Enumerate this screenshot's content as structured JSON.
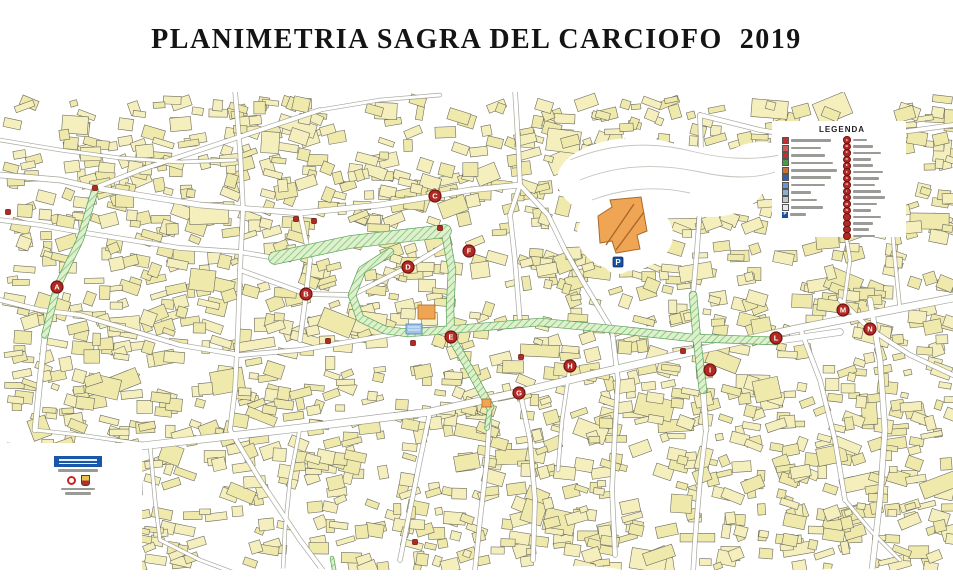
{
  "title": "PLANIMETRIA SAGRA DEL CARCIOFO  2019",
  "colors": {
    "building_fill": "#f4efbc",
    "building_fill_alt": "#efe9ac",
    "building_stroke": "#6e6d60",
    "street_casing": "#8a8a7e",
    "street_fill": "#ffffff",
    "route_fill": "#dff0cc",
    "route_hatch": "#7cc27c",
    "route_border": "#58a058",
    "marker_red": "#b22822",
    "marker_ring": "#701310",
    "special_orange": "#f0a555",
    "special_orange_outline": "#a96a28",
    "parking_blue": "#1a4fa0",
    "water_blue": "#9cc4e8",
    "contour_gray": "#c5c5bc"
  },
  "legend": {
    "title": "LEGENDA",
    "note": "legend label text is illegible at source resolution",
    "left_items": [
      {
        "icon_color": "#c03030",
        "bar_w": 40,
        "label_legible": false
      },
      {
        "icon_color": "#d85858",
        "bar_w": 30,
        "label_legible": false
      },
      {
        "icon_color": "#c03030",
        "bar_w": 34,
        "label_legible": false
      },
      {
        "icon_color": "#4a9a4a",
        "bar_w": 42,
        "label_legible": false
      },
      {
        "icon_color": "#d07030",
        "bar_w": 46,
        "label_legible": false
      },
      {
        "icon_color": "#3060b0",
        "bar_w": 40,
        "label_legible": false
      },
      {
        "icon_color": "#6a94d4",
        "bar_w": 34,
        "label_legible": false
      },
      {
        "icon_color": "#8ab0d0",
        "bar_w": 20,
        "label_legible": false
      },
      {
        "icon_color": "#c8c8c8",
        "bar_w": 26,
        "label_legible": false
      },
      {
        "icon_color": "#e8e8e8",
        "bar_w": 32,
        "label_legible": false
      },
      {
        "icon_color": "#1a4fa0",
        "bar_w": 16,
        "label_legible": false,
        "parking": true
      }
    ],
    "right_items": [
      {
        "letter": "A",
        "bar_w": 14
      },
      {
        "letter": "B",
        "bar_w": 20
      },
      {
        "letter": "C",
        "bar_w": 28
      },
      {
        "letter": "D",
        "bar_w": 18
      },
      {
        "letter": "E",
        "bar_w": 20
      },
      {
        "letter": "F",
        "bar_w": 30
      },
      {
        "letter": "G",
        "bar_w": 26
      },
      {
        "letter": "H",
        "bar_w": 22
      },
      {
        "letter": "I",
        "bar_w": 28
      },
      {
        "letter": "L",
        "bar_w": 32
      },
      {
        "letter": "M",
        "bar_w": 24
      },
      {
        "letter": "N",
        "bar_w": 18
      },
      {
        "letter": "",
        "bar_w": 28
      },
      {
        "letter": "",
        "bar_w": 20
      },
      {
        "letter": "",
        "bar_w": 16
      },
      {
        "letter": "",
        "bar_w": 22
      }
    ]
  },
  "markers": [
    {
      "letter": "A",
      "x": 57,
      "y": 287
    },
    {
      "letter": "B",
      "x": 306,
      "y": 294
    },
    {
      "letter": "C",
      "x": 435,
      "y": 196
    },
    {
      "letter": "D",
      "x": 408,
      "y": 267
    },
    {
      "letter": "E",
      "x": 451,
      "y": 337
    },
    {
      "letter": "F",
      "x": 469,
      "y": 251
    },
    {
      "letter": "G",
      "x": 519,
      "y": 393
    },
    {
      "letter": "H",
      "x": 570,
      "y": 366
    },
    {
      "letter": "I",
      "x": 710,
      "y": 370
    },
    {
      "letter": "L",
      "x": 776,
      "y": 338
    },
    {
      "letter": "M",
      "x": 843,
      "y": 310
    },
    {
      "letter": "N",
      "x": 870,
      "y": 329
    }
  ],
  "small_markers": [
    {
      "x": 95,
      "y": 188
    },
    {
      "x": 8,
      "y": 212
    },
    {
      "x": 296,
      "y": 219
    },
    {
      "x": 314,
      "y": 221
    },
    {
      "x": 440,
      "y": 228
    },
    {
      "x": 328,
      "y": 341
    },
    {
      "x": 413,
      "y": 343
    },
    {
      "x": 683,
      "y": 351
    },
    {
      "x": 521,
      "y": 357
    },
    {
      "x": 415,
      "y": 542
    }
  ],
  "parking": {
    "label": "P",
    "x": 618,
    "y": 262
  },
  "special_buildings": {
    "church_complex": {
      "points": "598,216 612,207 610,200 641,197 647,231 637,235 640,249 616,253 612,241 600,243",
      "x": 620,
      "y": 225
    },
    "stand_center": {
      "x": 418,
      "y": 305,
      "w": 17,
      "h": 14
    },
    "stand_south": {
      "x": 482,
      "y": 399,
      "w": 9,
      "h": 8
    }
  },
  "fountain": {
    "x": 406,
    "y": 324,
    "w": 16,
    "h": 10
  },
  "logo_block": {
    "legible": false,
    "banner_color": "#1a57a8"
  }
}
